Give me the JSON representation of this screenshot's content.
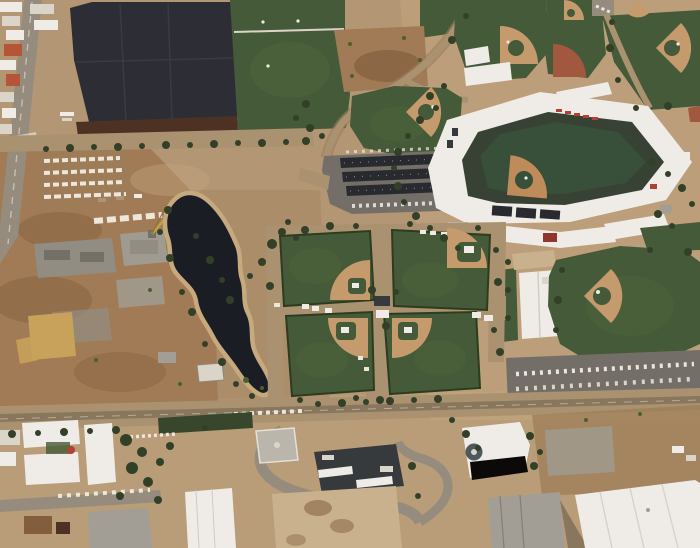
{
  "scene": {
    "type": "aerial-photograph",
    "description": "Oblique daytime aerial view of a desert spring-training baseball complex: a white-roofed main stadium at the upper right, a cloverleaf of four practice diamonds at center, additional practice fields top and right, a dark pond and a solar-canopy parking lot in the middle, a dirt construction site and a highway with red-roofed buildings on the left, green multipurpose fields at top, and a commercial strip with white, dark and beige rooftops along a road across the bottom.",
    "counts": {
      "stadiums": 1,
      "practice-diamonds": 10,
      "ponds": 1
    }
  },
  "palette": {
    "desert": "#b29572",
    "desertLight": "#c2a87f",
    "desertDark": "#9b7b55",
    "construction": "#9e7951",
    "dirtDark": "#7e5a3a",
    "grass": "#3c5632",
    "grassLight": "#4c683c",
    "grassDark": "#2c4024",
    "stadiumTurf": "#2f4a33",
    "seatBowl": "#2e3c2e",
    "infield": "#c59a6b",
    "infieldStad": "#bf8a58",
    "redDirt": "#a0523a",
    "water": "#10151d",
    "shore": "#c6a97c",
    "darkLot": "#24272f",
    "darkLotSeam": "#31343d",
    "brownStrip": "#462b1c",
    "asphalt": "#6e6b64",
    "canopy": "#1f232a",
    "roadTan": "#a8906e",
    "roadGray": "#938b7d",
    "roadDark": "#847459",
    "white": "#f2f1ec",
    "offWhite": "#dcd7cb",
    "grayRoof": "#a09e95",
    "grayRoofLight": "#b9b7ae",
    "darkRoof": "#2e3338",
    "beigeRoof": "#c9b28d",
    "redRoof": "#8e2f28",
    "redAccent": "#b23a2e",
    "orangeRoof": "#b44f30",
    "sand": "#c8a257",
    "crane": "#c8a23c",
    "treeDark": "#2a3a21",
    "treeLight": "#46592f",
    "hedge": "#2f4026",
    "slab": "#8e8c82",
    "slabLight": "#9d9b91",
    "slabDark": "#6f6d64",
    "towerDark": "#46545c",
    "carWhite": "#eeeae0",
    "haze": "#c9b295"
  },
  "features": [
    {
      "name": "main-stadium",
      "label": "Main baseball stadium"
    },
    {
      "name": "cloverleaf-fields",
      "label": "Four-field practice cloverleaf"
    },
    {
      "name": "pond",
      "label": "Irrigation pond"
    },
    {
      "name": "solar-parking-lot",
      "label": "Parking lot with solar canopies"
    },
    {
      "name": "construction-site",
      "label": "Construction site"
    },
    {
      "name": "dark-lot",
      "label": "Large dark lot"
    },
    {
      "name": "soccer-fields",
      "label": "Grass multipurpose fields"
    },
    {
      "name": "south-road",
      "label": "Arterial road"
    },
    {
      "name": "commercial-strip",
      "label": "Commercial buildings"
    }
  ]
}
